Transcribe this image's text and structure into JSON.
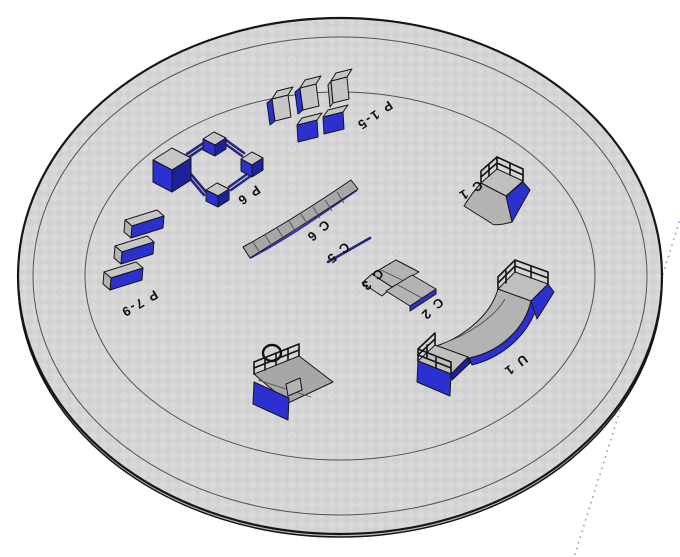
{
  "equipment": [
    {
      "id": "p1-5",
      "label": "P 1-5"
    },
    {
      "id": "p6",
      "label": "P 6"
    },
    {
      "id": "p7-9",
      "label": "P 7-9"
    },
    {
      "id": "c6",
      "label": "C 6"
    },
    {
      "id": "c5",
      "label": "C 5"
    },
    {
      "id": "c3",
      "label": "C 3"
    },
    {
      "id": "c2",
      "label": "C 2"
    },
    {
      "id": "c1",
      "label": "C 1"
    },
    {
      "id": "u1",
      "label": "U 1"
    }
  ],
  "colors": {
    "blue": "#2c30cf",
    "blue_dark": "#1e219c",
    "navy_rail": "#23277f",
    "gray_top": "#c6c6c6",
    "gray_face": "#b3b3b3",
    "gray_slope": "#a7a7a7",
    "gray_deck": "#bfbfbf",
    "platform": "#d9d9d9",
    "platform_check": "#d1d1d4",
    "ring": "#3c3c3c",
    "outline": "#161616",
    "label": "#0e0e0e",
    "rail_black": "#121212",
    "guide_dot": "#9096c4",
    "background": "#ffffff"
  }
}
